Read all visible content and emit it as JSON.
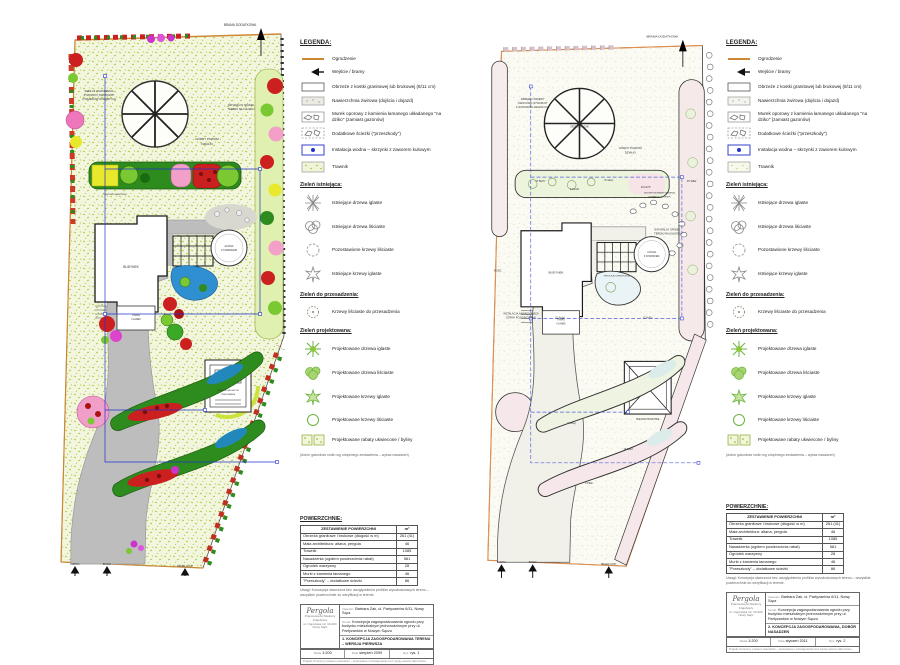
{
  "legend": {
    "title": "LEGENDA:",
    "surface_items": [
      {
        "icon": "fence-icon",
        "label": "Ogrodzenie"
      },
      {
        "icon": "gate-arrow-icon",
        "label": "Wejście / bramy"
      },
      {
        "icon": "curb-icon",
        "label": "Obrzeże z kostki granitowej lub brukowej (8/11 cm)"
      },
      {
        "icon": "gravel-surface-icon",
        "label": "Nawierzchnia żwirowa (dojścia i dojazd)"
      },
      {
        "icon": "stone-wall-icon",
        "label": "Murek oporowy z kamienia łamanego układanego \"na dziko\" (zamiast gazonów)"
      },
      {
        "icon": "stepping-path-icon",
        "label": "Dodatkowe ścieżki (\"przeszkody\")"
      },
      {
        "icon": "water-box-icon",
        "label": "Instalacja wodna – skrzynki z zaworem kulowym"
      },
      {
        "icon": "lawn-icon",
        "label": "Trawnik"
      }
    ],
    "sections": {
      "existing": {
        "title": "Zieleń istniejąca:",
        "items": [
          {
            "icon": "existing-conifer-tree-icon",
            "label": "Istniejące drzewa iglaste"
          },
          {
            "icon": "existing-deciduous-tree-icon",
            "label": "Istniejące drzewa liściaste"
          },
          {
            "icon": "kept-deciduous-shrub-icon",
            "label": "Pozostawione krzewy liściaste"
          },
          {
            "icon": "existing-conifer-shrub-icon",
            "label": "Istniejące krzewy iglaste"
          }
        ]
      },
      "transplant": {
        "title": "Zieleń do przesadzenia:",
        "items": [
          {
            "icon": "transplant-shrub-icon",
            "label": "Krzewy liściaste do przesadzenia"
          }
        ]
      },
      "designed": {
        "title": "Zieleń projektowana:",
        "items": [
          {
            "icon": "new-conifer-tree-icon",
            "label": "Projektowane drzewa iglaste"
          },
          {
            "icon": "new-deciduous-tree-icon",
            "label": "Projektowane drzewa liściaste"
          },
          {
            "icon": "new-conifer-shrub-icon",
            "label": "Projektowane krzewy iglaste"
          },
          {
            "icon": "new-deciduous-shrub-icon",
            "label": "Projektowane krzewy liściaste"
          },
          {
            "icon": "flower-bed-icon",
            "label": "Projektowane rabaty ukwiecone / byliny"
          }
        ],
        "note": "(dobór gatunków roślin wg odrębnego zestawienia – wykaz nasadzeń)"
      }
    }
  },
  "areas": {
    "title": "POWIERZCHNIE:",
    "header_label": "ZESTAWIENIE POWIERZCHNI",
    "header_unit": "m²",
    "rows": [
      {
        "name": "Obrzeża granitowe i brukowe (długość w m)",
        "value": "261 (41)"
      },
      {
        "name": "Mała architektura: altana, pergola",
        "value": "46"
      },
      {
        "name": "Trawnik",
        "value": "1085"
      },
      {
        "name": "Nasadzenia (ogółem powierzchnia rabat)",
        "value": "581"
      },
      {
        "name": "Ogródek warzywny",
        "value": "28"
      },
      {
        "name": "Murki z kamienia łamanego",
        "value": "46"
      },
      {
        "name": "\"Przeszkody\" – dodatkowe ścieżki",
        "value": "86"
      }
    ],
    "note": "Uwagi: Koncepcja utworzona bez uwzględnienia profilów wysokościowych terenu – wszystkie powierzchnie do weryfikacji w terenie."
  },
  "titleblock": {
    "firm_brand": "Pergola",
    "firm_name": "Pracownia Architektury Krajobrazu",
    "firm_addr": "ul. Ogrodowa 12, 33-300 Nowy Sącz",
    "client_label": "Inwestor:",
    "client": "Barbara Żak, ul. Partyzantów 6/11, Nowy Sącz",
    "project_label": "Temat:",
    "project": "Koncepcja zagospodarowania ogrodu przy budynku mieszkalnym jednorodzinnym przy ul. Partyzantów w Nowym Sączu",
    "scale_label": "Skala",
    "date_label": "Data",
    "sheet_label": "Rys.",
    "copyright": "Projekt chroniony prawem autorskim – kopiowanie i udostępnianie bez zgody autora zabronione.",
    "left": {
      "drawing": "1. KONCEPCJA ZAGOSPODAROWANIA TERENU – WERSJA PIERWSZA",
      "scale": "1:200",
      "date": "sierpień 2009",
      "sheet": "rys. 1"
    },
    "right": {
      "drawing": "2. KONCEPCJA ZAGOSPODAROWANIA, DOBÓR NASADZEŃ",
      "scale": "1:200",
      "date": "styczeń 2011",
      "sheet": "rys. 2"
    }
  },
  "gates": {
    "top": "BRAMA DODATKOWA",
    "g1": "FURTKA",
    "g2": "BRAMA",
    "g3": "BRAMA GOSP."
  },
  "plan_left": {
    "labels": {
      "hedge1": "WZDŁUŻ OGRODZENIA",
      "hedge2": "ŻYWOPŁOT SWOBODNY",
      "hedge3": "Z KRZEWÓW OZDOBNYCH",
      "gorny1": "GÓRNY POZIOM",
      "gorny2": "DZIAŁKI",
      "natural1": "NATURALNY SPADEK",
      "natural2": "TERENU NA CAŁOŚCI",
      "budynek": "BUDYNEK",
      "taras1": "TARAS",
      "taras2": "I GANEK",
      "altana1": "ALTANA",
      "altana2": "Z KOMINKIEM",
      "grill1": "MIEJSCE NA GRILLA",
      "grill2": "I WĘDZARNIĘ",
      "ogrodek": "OGRÓDEK WARZYWNY"
    }
  },
  "plan_right": {
    "labels": {
      "owocowe1": "DRZEWA I KRZEWY",
      "owocowe2": "OWOCOWE (ŻYWOPŁOT",
      "owocowe3": "Z GATUNKÓW JADALNYCH)",
      "gorny1": "GÓRNY POZIOM",
      "gorny2": "DZIAŁKI",
      "natural1": "NATURALNY SPADEK",
      "natural2": "TERENU NA CAŁOŚCI",
      "instal1": "INSTALACJA NAWADNIAJĄCA",
      "instal2": "GÓRNY POZIOM DZIAŁKI",
      "kojec": "KOJEC",
      "orzech": "ORZECH WŁOSKI",
      "budynek": "BUDYNEK",
      "taras1": "TARAS",
      "taras2": "I GANEK",
      "altana1": "ALTANA",
      "altana2": "Z KOMINKIEM",
      "pergola": "PERGOLA Z WINOROŚLĄ",
      "skalniak1": "WKOMPONOWANIE KAMIENIA",
      "skalniak2": "ŁAMANEGO W TEREN",
      "piknik": "MIEJSCE PIKNIKOWE"
    },
    "plant_codes": [
      "27 BeTh'",
      "14 RoZł'",
      "8 LaKą'",
      "32 FaTh'",
      "21 SpJa'",
      "45 TaBa'",
      "12 HoFo'",
      "9 JuSq'",
      "18 CoAl'",
      "6 PiMu'"
    ]
  }
}
